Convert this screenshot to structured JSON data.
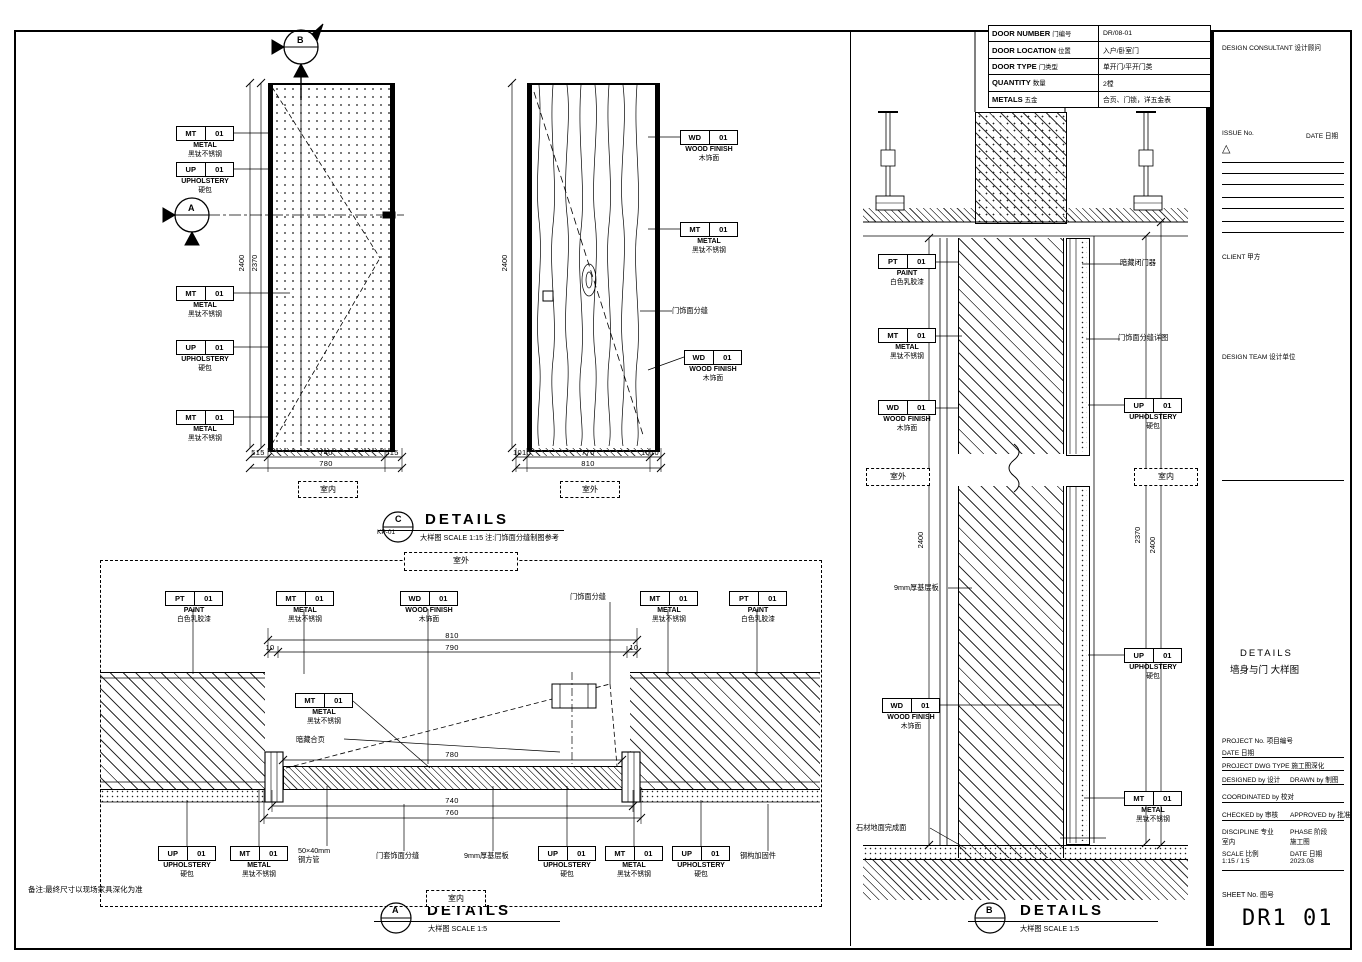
{
  "sheet": {
    "number": "DR1 01",
    "sheet_no_label": "SHEET No.  图号"
  },
  "door_table": {
    "rows": [
      {
        "label": "DOOR NUMBER",
        "label_cn": "门编号",
        "value": "DR/08-01"
      },
      {
        "label": "DOOR LOCATION",
        "label_cn": "位置",
        "value": "入户/卧室门"
      },
      {
        "label": "DOOR TYPE",
        "label_cn": "门类型",
        "value": "单开门/平开门类"
      },
      {
        "label": "QUANTITY",
        "label_cn": "数量",
        "value": "2樘"
      },
      {
        "label": "METALS",
        "label_cn": "五金",
        "value": "合页、门锁，详五金表"
      }
    ]
  },
  "titles": {
    "c": {
      "letter": "C",
      "ref": "KP-01",
      "title": "DETAILS",
      "scale": "大样图  SCALE 1:15  注:门饰面分缝制图参考"
    },
    "a": {
      "letter": "A",
      "title": "DETAILS",
      "scale": "大样图   SCALE 1:5"
    },
    "b": {
      "letter": "B",
      "title": "DETAILS",
      "scale": "大样图   SCALE 1:5"
    }
  },
  "markers": {
    "a": "A",
    "b": "B"
  },
  "view_tags": {
    "interior": "室内",
    "exterior": "室外"
  },
  "dims": {
    "elev1": {
      "h1": "2400",
      "h2": "2370",
      "w_side_l": "515",
      "w_mid": "740",
      "w_side_r": "515",
      "w_total": "780"
    },
    "elev2": {
      "h1": "2400",
      "w_side_l": "1010",
      "w_mid": "770",
      "w_side_r": "1010",
      "w_total": "810"
    },
    "plan": {
      "w_total": "810",
      "w_l": "10",
      "w_mid": "790",
      "w_r": "10",
      "leaf": "780",
      "w2": "740",
      "w3": "760"
    },
    "section": {
      "h_l": "2400",
      "h_r1": "2370",
      "h_r2": "2400"
    }
  },
  "note": "备注:最终尺寸以现场家具深化为准",
  "callouts": [
    {
      "code": "MT",
      "num": "01",
      "en": "METAL",
      "cn": "黑钛不锈钢"
    },
    {
      "code": "UP",
      "num": "01",
      "en": "UPHOLSTERY",
      "cn": "硬包"
    },
    {
      "code": "MT",
      "num": "01",
      "en": "METAL",
      "cn": "黑钛不锈钢"
    },
    {
      "code": "UP",
      "num": "01",
      "en": "UPHOLSTERY",
      "cn": "硬包"
    },
    {
      "code": "MT",
      "num": "01",
      "en": "METAL",
      "cn": "黑钛不锈钢"
    },
    {
      "code": "WD",
      "num": "01",
      "en": "WOOD FINISH",
      "cn": "木饰面"
    },
    {
      "code": "MT",
      "num": "01",
      "en": "METAL",
      "cn": "黑钛不锈钢"
    },
    {
      "text": "门饰面分缝"
    },
    {
      "code": "WD",
      "num": "01",
      "en": "WOOD FINISH",
      "cn": "木饰面"
    },
    {
      "code": "PT",
      "num": "01",
      "en": "PAINT",
      "cn": "白色乳胶漆"
    },
    {
      "code": "MT",
      "num": "01",
      "en": "METAL",
      "cn": "黑钛不锈钢"
    },
    {
      "code": "WD",
      "num": "01",
      "en": "WOOD FINISH",
      "cn": "木饰面"
    },
    {
      "text": "门饰面分缝"
    },
    {
      "code": "MT",
      "num": "01",
      "en": "METAL",
      "cn": "黑钛不锈钢"
    },
    {
      "code": "PT",
      "num": "01",
      "en": "PAINT",
      "cn": "白色乳胶漆"
    },
    {
      "code": "MT",
      "num": "01",
      "en": "METAL",
      "cn": "黑钛不锈钢"
    },
    {
      "text": "暗藏合页"
    },
    {
      "code": "UP",
      "num": "01",
      "en": "UPHOLSTERY",
      "cn": "硬包"
    },
    {
      "code": "MT",
      "num": "01",
      "en": "METAL",
      "cn": "黑钛不锈钢"
    },
    {
      "lines": [
        "50×40mm",
        "钢方管"
      ]
    },
    {
      "text": "门套饰面分缝"
    },
    {
      "text": "9mm厚基层板"
    },
    {
      "code": "UP",
      "num": "01",
      "en": "UPHOLSTERY",
      "cn": "硬包"
    },
    {
      "code": "MT",
      "num": "01",
      "en": "METAL",
      "cn": "黑钛不锈钢"
    },
    {
      "code": "UP",
      "num": "01",
      "en": "UPHOLSTERY",
      "cn": "硬包"
    },
    {
      "text": "钢构加固件"
    },
    {
      "code": "PT",
      "num": "01",
      "en": "PAINT",
      "cn": "白色乳胶漆"
    },
    {
      "code": "MT",
      "num": "01",
      "en": "METAL",
      "cn": "黑钛不锈钢"
    },
    {
      "code": "WD",
      "num": "01",
      "en": "WOOD FINISH",
      "cn": "木饰面"
    },
    {
      "text": "9mm厚基层板"
    },
    {
      "code": "WD",
      "num": "01",
      "en": "WOOD FINISH",
      "cn": "木饰面"
    },
    {
      "text": "石材地面完成面"
    },
    {
      "text": "暗藏闭门器"
    },
    {
      "text": "门饰面分缝详图"
    },
    {
      "code": "UP",
      "num": "01",
      "en": "UPHOLSTERY",
      "cn": "硬包"
    },
    {
      "code": "UP",
      "num": "01",
      "en": "UPHOLSTERY",
      "cn": "硬包"
    },
    {
      "code": "MT",
      "num": "01",
      "en": "METAL",
      "cn": "黑钛不锈钢"
    }
  ],
  "title_block": {
    "logo": "DESIGN CONSULTANT 设计顾问",
    "issue_label": "ISSUE No.",
    "issue_date_label": "DATE 日期",
    "revision_symbol": "△",
    "client_label": "CLIENT 甲方",
    "design_team_label": "DESIGN TEAM 设计单位",
    "drawing_title_en": "DETAILS",
    "drawing_title_cn": "墙身与门 大样图",
    "project_no_label": "PROJECT No.  项目编号",
    "date_label": "DATE 日期",
    "dwg_type_label": "PROJECT DWG TYPE  施工图深化",
    "designed_label": "DESIGNED by 设计",
    "drawn_label": "DRAWN by 制图",
    "coordinated_label": "COORDINATED by 校对",
    "checked_label": "CHECKED by 审核",
    "approved_label": "APPROVED by 批准",
    "discipline_label": "DISCIPLINE 专业",
    "discipline_value": "室内",
    "phase_label": "PHASE 阶段",
    "phase_value": "施工图",
    "scale_label": "SCALE 比例",
    "scale_value": "1:15 / 1:5",
    "date_value": "2023.08"
  }
}
